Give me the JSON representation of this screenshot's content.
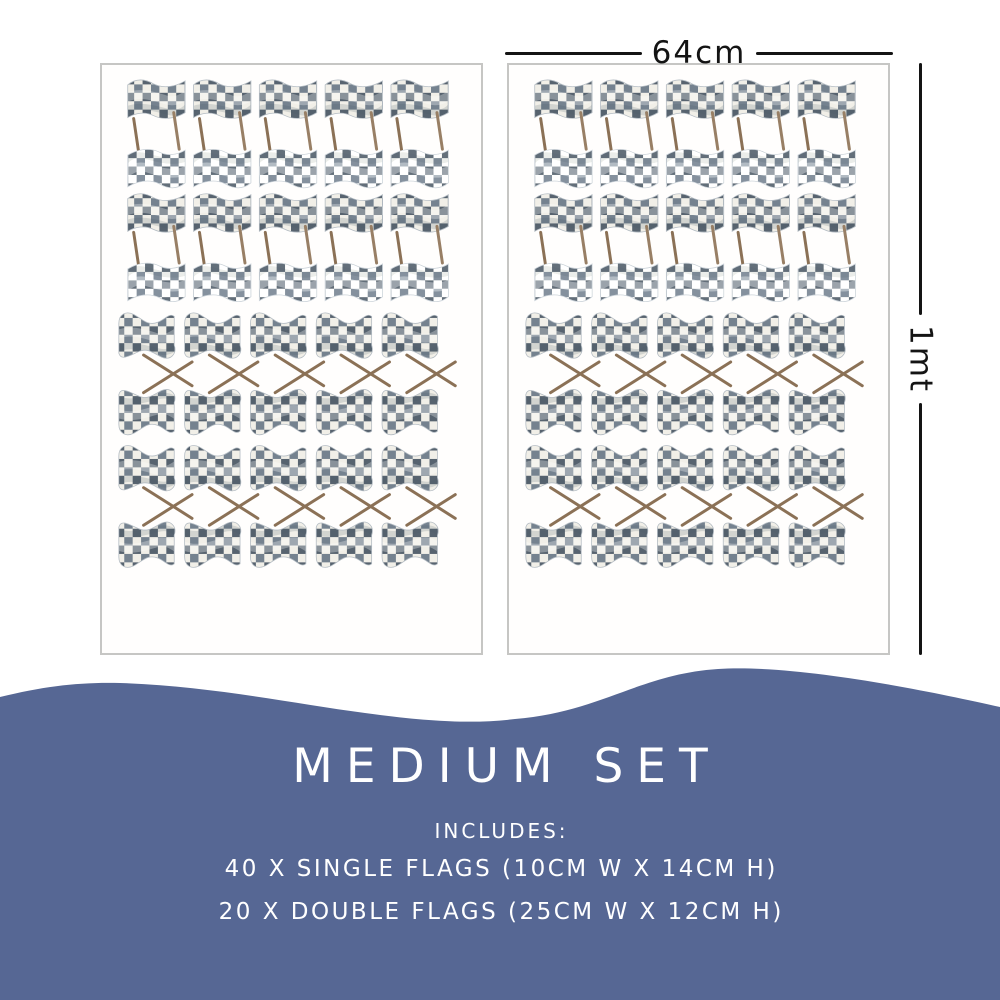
{
  "dimensions": {
    "width_label": "64cm",
    "height_label": "1mt"
  },
  "product": {
    "title": "MEDIUM SET",
    "includes_label": "INCLUDES:",
    "spec_lines": [
      "40 X SINGLE FLAGS (10CM W X 14CM H)",
      "20 X DOUBLE FLAGS (25CM W X 12CM H)"
    ]
  },
  "sheets": {
    "count": 2,
    "description": "checkered-flag-decal-sheet"
  },
  "sheet_layout": {
    "single": {
      "rows": 4,
      "cols": 5,
      "x0": 24,
      "y0": 10,
      "col_pitch": 66.5,
      "pair_pitch": 115,
      "flag_w": 62,
      "pair_offset": 117
    },
    "double": {
      "rows": 2,
      "cols": 5,
      "x0": 14,
      "y0": 246,
      "col_pitch": 66.5,
      "row_pitch": 134
    }
  },
  "colors": {
    "accent_blue": "#566794",
    "flag_check_dark": "#57636f",
    "flag_check_mid": "#75828f",
    "flag_check_light": "#f1efe8",
    "stick_brown": "#8b7156",
    "panel_border": "#c6c6c4",
    "dimension_ink": "#141414",
    "caption_text": "#ffffff"
  }
}
